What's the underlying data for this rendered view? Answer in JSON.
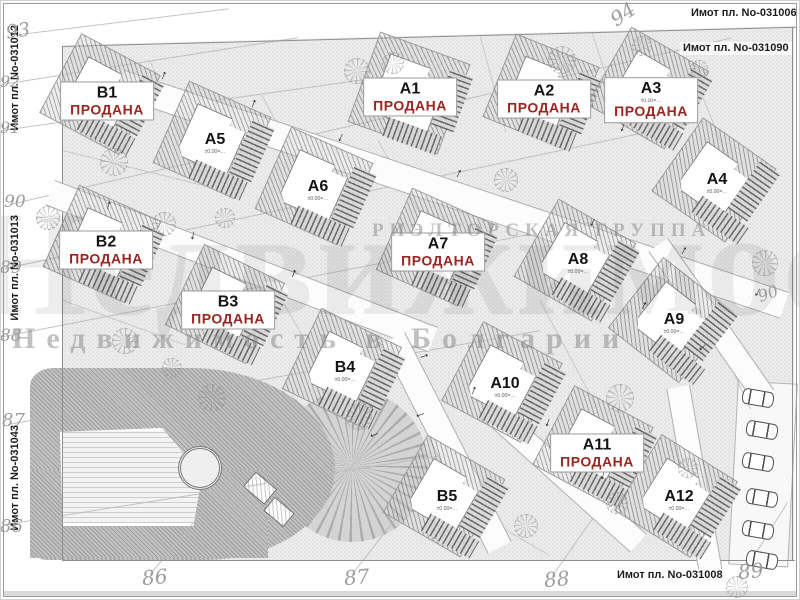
{
  "meta": {
    "sold_label": "ПРОДАНА",
    "sold_color": "#992621",
    "elev_label": "±0.00=…",
    "arrow_glyph": "↓"
  },
  "watermark": {
    "group": "РИЭЛТОРСКАЯ ГРУППА",
    "tagline": "Недвижимость в Болгарии"
  },
  "plot_labels": [
    {
      "text": "Имот пл. No-031006",
      "x": 688,
      "y": 7,
      "vert": false
    },
    {
      "text": "Имот пл. No-031090",
      "x": 680,
      "y": 42,
      "vert": false
    },
    {
      "text": "Имот пл. No-031008",
      "x": 614,
      "y": 569,
      "vert": false
    },
    {
      "text": "Имот пл. No-031012",
      "x": 6,
      "y": 25,
      "vert": true
    },
    {
      "text": "Имот пл. No-031013",
      "x": 6,
      "y": 215,
      "vert": true
    },
    {
      "text": "Имот пл. No-031043",
      "x": 6,
      "y": 425,
      "vert": true
    }
  ],
  "contour_numbers": [
    {
      "t": "93",
      "x": 6,
      "y": 22,
      "s": 19,
      "a": -8
    },
    {
      "t": "92",
      "x": 0,
      "y": 74,
      "s": 16,
      "a": 0
    },
    {
      "t": "91",
      "x": 0,
      "y": 120,
      "s": 16,
      "a": 0
    },
    {
      "t": "90",
      "x": 4,
      "y": 194,
      "s": 17,
      "a": 0
    },
    {
      "t": "89",
      "x": 0,
      "y": 260,
      "s": 17,
      "a": 0
    },
    {
      "t": "88",
      "x": 0,
      "y": 328,
      "s": 17,
      "a": 0
    },
    {
      "t": "87",
      "x": 2,
      "y": 412,
      "s": 18,
      "a": 0
    },
    {
      "t": "86",
      "x": 0,
      "y": 518,
      "s": 18,
      "a": 0
    },
    {
      "t": "94",
      "x": 610,
      "y": 4,
      "s": 20,
      "a": -35
    },
    {
      "t": "86",
      "x": 142,
      "y": 567,
      "s": 20,
      "a": -5
    },
    {
      "t": "87",
      "x": 344,
      "y": 567,
      "s": 20,
      "a": -5
    },
    {
      "t": "88",
      "x": 544,
      "y": 569,
      "s": 20,
      "a": -5
    },
    {
      "t": "89",
      "x": 738,
      "y": 561,
      "s": 20,
      "a": -5
    },
    {
      "t": "90",
      "x": 758,
      "y": 286,
      "s": 16,
      "a": -20
    }
  ],
  "houses": [
    {
      "id": "B1",
      "label": "B1",
      "x": 56,
      "y": 50,
      "s": 88,
      "rot": 28,
      "lx": 107,
      "ly": 101,
      "sold": true,
      "elev": false
    },
    {
      "id": "A5",
      "label": "A5",
      "x": 168,
      "y": 96,
      "s": 88,
      "rot": 24,
      "lx": 215,
      "ly": 143,
      "sold": false,
      "elev": true
    },
    {
      "id": "A6",
      "label": "A6",
      "x": 270,
      "y": 142,
      "s": 88,
      "rot": 24,
      "lx": 318,
      "ly": 190,
      "sold": false,
      "elev": true
    },
    {
      "id": "A1",
      "label": "A1",
      "x": 362,
      "y": 46,
      "s": 94,
      "rot": 20,
      "lx": 410,
      "ly": 97,
      "sold": true,
      "elev": false
    },
    {
      "id": "A2",
      "label": "A2",
      "x": 497,
      "y": 48,
      "s": 88,
      "rot": 22,
      "lx": 544,
      "ly": 99,
      "sold": true,
      "elev": false
    },
    {
      "id": "A3",
      "label": "A3",
      "x": 604,
      "y": 44,
      "s": 88,
      "rot": 30,
      "lx": 651,
      "ly": 100,
      "sold": true,
      "elev": true
    },
    {
      "id": "A4",
      "label": "A4",
      "x": 670,
      "y": 136,
      "s": 88,
      "rot": 35,
      "lx": 717,
      "ly": 183,
      "sold": false,
      "elev": true
    },
    {
      "id": "B2",
      "label": "B2",
      "x": 58,
      "y": 200,
      "s": 88,
      "rot": 24,
      "lx": 106,
      "ly": 250,
      "sold": true,
      "elev": false
    },
    {
      "id": "B3",
      "label": "B3",
      "x": 181,
      "y": 260,
      "s": 88,
      "rot": 26,
      "lx": 228,
      "ly": 310,
      "sold": true,
      "elev": false
    },
    {
      "id": "A7",
      "label": "A7",
      "x": 391,
      "y": 203,
      "s": 88,
      "rot": 24,
      "lx": 438,
      "ly": 252,
      "sold": true,
      "elev": false
    },
    {
      "id": "A8",
      "label": "A8",
      "x": 531,
      "y": 216,
      "s": 88,
      "rot": 30,
      "lx": 578,
      "ly": 263,
      "sold": false,
      "elev": true
    },
    {
      "id": "A9",
      "label": "A9",
      "x": 627,
      "y": 276,
      "s": 88,
      "rot": 38,
      "lx": 674,
      "ly": 323,
      "sold": false,
      "elev": true
    },
    {
      "id": "B4",
      "label": "B4",
      "x": 298,
      "y": 324,
      "s": 88,
      "rot": 26,
      "lx": 345,
      "ly": 371,
      "sold": false,
      "elev": true
    },
    {
      "id": "A10",
      "label": "A10",
      "x": 458,
      "y": 338,
      "s": 88,
      "rot": 28,
      "lx": 505,
      "ly": 387,
      "sold": false,
      "elev": true
    },
    {
      "id": "B5",
      "label": "B5",
      "x": 400,
      "y": 452,
      "s": 88,
      "rot": 30,
      "lx": 447,
      "ly": 500,
      "sold": false,
      "elev": true
    },
    {
      "id": "A11",
      "label": "A11",
      "x": 549,
      "y": 402,
      "s": 88,
      "rot": 28,
      "lx": 597,
      "ly": 453,
      "sold": true,
      "elev": false
    },
    {
      "id": "A12",
      "label": "A12",
      "x": 632,
      "y": 452,
      "s": 88,
      "rot": 32,
      "lx": 679,
      "ly": 500,
      "sold": false,
      "elev": true
    }
  ],
  "roads": [
    {
      "x": 125,
      "y": 70,
      "w": 700,
      "h": 26,
      "d": 18.5
    },
    {
      "x": 55,
      "y": 180,
      "w": 410,
      "h": 25,
      "d": 21
    },
    {
      "x": 405,
      "y": 332,
      "w": 235,
      "h": 25,
      "d": 63
    },
    {
      "x": 668,
      "y": 238,
      "w": 185,
      "h": 22,
      "d": 55
    },
    {
      "x": 690,
      "y": 385,
      "w": 190,
      "h": 22,
      "d": 80
    },
    {
      "x": 498,
      "y": 400,
      "w": 200,
      "h": 23,
      "d": 42
    }
  ],
  "boundaries": [
    {
      "x": 62,
      "y": 46,
      "w": 735,
      "h": 1,
      "d": -1.5
    },
    {
      "x": 62,
      "y": 46,
      "w": 1,
      "h": 514,
      "d": 0
    },
    {
      "x": 62,
      "y": 560,
      "w": 733,
      "h": 1,
      "d": 0
    },
    {
      "x": 792,
      "y": 27,
      "w": 1,
      "h": 533,
      "d": 0
    }
  ],
  "contour_lines": [
    {
      "x": 20,
      "y": 34,
      "w": 210,
      "d": -7
    },
    {
      "x": 2,
      "y": 84,
      "w": 300,
      "d": -9
    },
    {
      "x": 2,
      "y": 130,
      "w": 430,
      "d": -8
    },
    {
      "x": 10,
      "y": 204,
      "w": 740,
      "d": -13
    },
    {
      "x": 5,
      "y": 268,
      "w": 700,
      "d": -12
    },
    {
      "x": 4,
      "y": 336,
      "w": 600,
      "d": -11
    },
    {
      "x": 8,
      "y": 424,
      "w": 540,
      "d": -10
    },
    {
      "x": 6,
      "y": 524,
      "w": 450,
      "d": -9
    },
    {
      "x": 150,
      "y": 574,
      "w": 90,
      "d": -50
    },
    {
      "x": 352,
      "y": 574,
      "w": 90,
      "d": -52
    },
    {
      "x": 552,
      "y": 576,
      "w": 90,
      "d": -55
    },
    {
      "x": 745,
      "y": 570,
      "w": 80,
      "d": -58
    }
  ],
  "lot_lines": [
    {
      "x": 63,
      "y": 150,
      "w": 150,
      "d": 14
    },
    {
      "x": 150,
      "y": 60,
      "w": 110,
      "d": 68
    },
    {
      "x": 262,
      "y": 95,
      "w": 115,
      "d": 62
    },
    {
      "x": 378,
      "y": 140,
      "w": 110,
      "d": 60
    },
    {
      "x": 480,
      "y": 35,
      "w": 100,
      "d": 75
    },
    {
      "x": 592,
      "y": 32,
      "w": 95,
      "d": 72
    },
    {
      "x": 688,
      "y": 60,
      "w": 120,
      "d": 68
    },
    {
      "x": 63,
      "y": 300,
      "w": 130,
      "d": 20
    },
    {
      "x": 282,
      "y": 300,
      "w": 130,
      "d": 60
    },
    {
      "x": 540,
      "y": 300,
      "w": 120,
      "d": 62
    },
    {
      "x": 700,
      "y": 300,
      "w": 120,
      "d": 65
    },
    {
      "x": 420,
      "y": 480,
      "w": 150,
      "d": 30
    }
  ],
  "trees": [
    {
      "x": 100,
      "y": 148,
      "s": 26
    },
    {
      "x": 36,
      "y": 206,
      "s": 22
    },
    {
      "x": 152,
      "y": 212,
      "s": 22
    },
    {
      "x": 215,
      "y": 208,
      "s": 18
    },
    {
      "x": 344,
      "y": 58,
      "s": 24
    },
    {
      "x": 382,
      "y": 52,
      "s": 20
    },
    {
      "x": 548,
      "y": 46,
      "s": 26
    },
    {
      "x": 494,
      "y": 168,
      "s": 22
    },
    {
      "x": 752,
      "y": 250,
      "s": 24
    },
    {
      "x": 112,
      "y": 328,
      "s": 24
    },
    {
      "x": 198,
      "y": 384,
      "s": 26
    },
    {
      "x": 346,
      "y": 404,
      "s": 24
    },
    {
      "x": 162,
      "y": 358,
      "s": 18
    },
    {
      "x": 606,
      "y": 384,
      "s": 26
    },
    {
      "x": 514,
      "y": 514,
      "s": 22
    },
    {
      "x": 606,
      "y": 492,
      "s": 20
    },
    {
      "x": 678,
      "y": 458,
      "s": 18
    },
    {
      "x": 726,
      "y": 576,
      "s": 20
    },
    {
      "x": 632,
      "y": 36,
      "s": 18
    },
    {
      "x": 690,
      "y": 60,
      "s": 16
    }
  ],
  "arrows": [
    {
      "x": 160,
      "y": 70,
      "a": 200
    },
    {
      "x": 250,
      "y": 98,
      "a": 200
    },
    {
      "x": 338,
      "y": 130,
      "a": 25
    },
    {
      "x": 455,
      "y": 168,
      "a": 205
    },
    {
      "x": 590,
      "y": 215,
      "a": 30
    },
    {
      "x": 680,
      "y": 245,
      "a": 210
    },
    {
      "x": 755,
      "y": 285,
      "a": 30
    },
    {
      "x": 105,
      "y": 200,
      "a": 195
    },
    {
      "x": 190,
      "y": 228,
      "a": 15
    },
    {
      "x": 290,
      "y": 268,
      "a": 200
    },
    {
      "x": 420,
      "y": 350,
      "a": 250
    },
    {
      "x": 418,
      "y": 408,
      "a": 70
    },
    {
      "x": 372,
      "y": 428,
      "a": 70
    },
    {
      "x": 470,
      "y": 385,
      "a": 200
    },
    {
      "x": 545,
      "y": 415,
      "a": 20
    },
    {
      "x": 600,
      "y": 468,
      "a": 15
    },
    {
      "x": 700,
      "y": 340,
      "a": 50
    },
    {
      "x": 640,
      "y": 300,
      "a": 210
    },
    {
      "x": 525,
      "y": 95,
      "a": 200
    },
    {
      "x": 620,
      "y": 120,
      "a": 20
    }
  ],
  "cars": [
    {
      "x": 742,
      "y": 390
    },
    {
      "x": 746,
      "y": 422
    },
    {
      "x": 742,
      "y": 454
    },
    {
      "x": 746,
      "y": 490
    },
    {
      "x": 742,
      "y": 522
    },
    {
      "x": 746,
      "y": 552
    }
  ]
}
